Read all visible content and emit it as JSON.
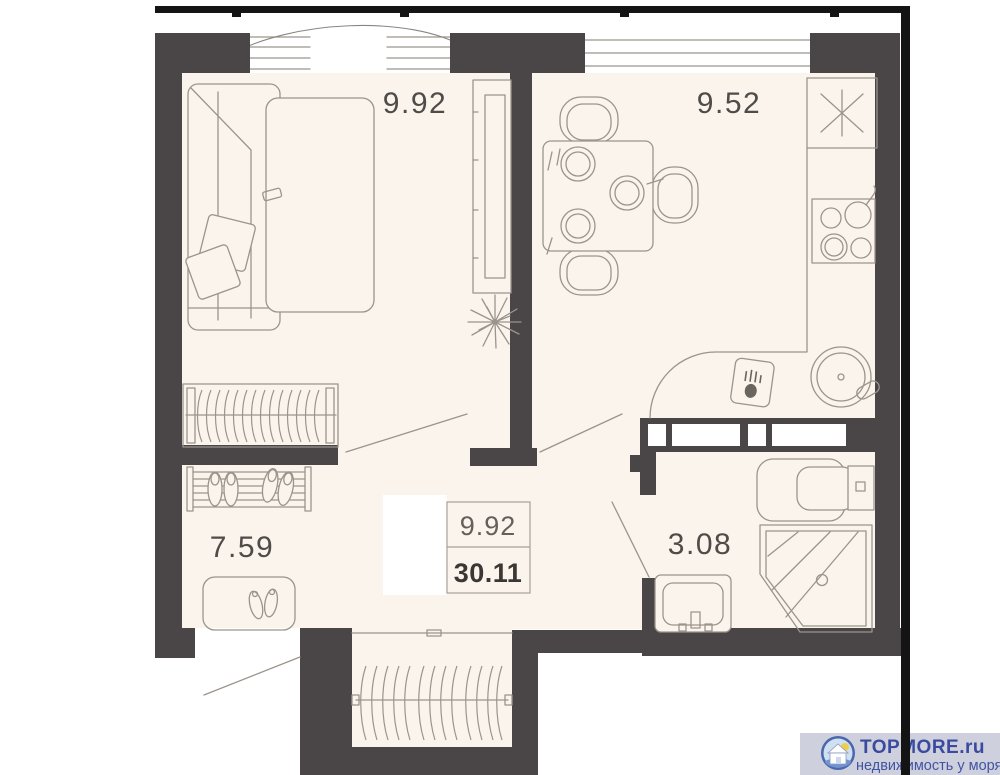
{
  "colors": {
    "wall": "#4a4546",
    "frame": "#141414",
    "floor": "#faf4ec",
    "line": "#9b948d",
    "label": "#4f4b49",
    "tborder": "#a5a09a",
    "brand": "#3b4a9e",
    "tagline": "#4153a3",
    "barbg": "#ced1dd",
    "ring": "#4a66ad",
    "sky": "#cfe0f2",
    "sun": "#edcf4e"
  },
  "rooms": {
    "bedroom": {
      "name": "bedroom",
      "area": "9.92"
    },
    "kitchen": {
      "name": "kitchen",
      "area": "9.52"
    },
    "hall": {
      "name": "hall",
      "area": "7.59"
    },
    "bathroom": {
      "name": "bathroom",
      "area": "3.08"
    }
  },
  "summary": {
    "living_area": "9.92",
    "total_area": "30.11"
  },
  "watermark": {
    "brand": "TOPMORE.ru",
    "tagline": "недвижимость у моря"
  }
}
